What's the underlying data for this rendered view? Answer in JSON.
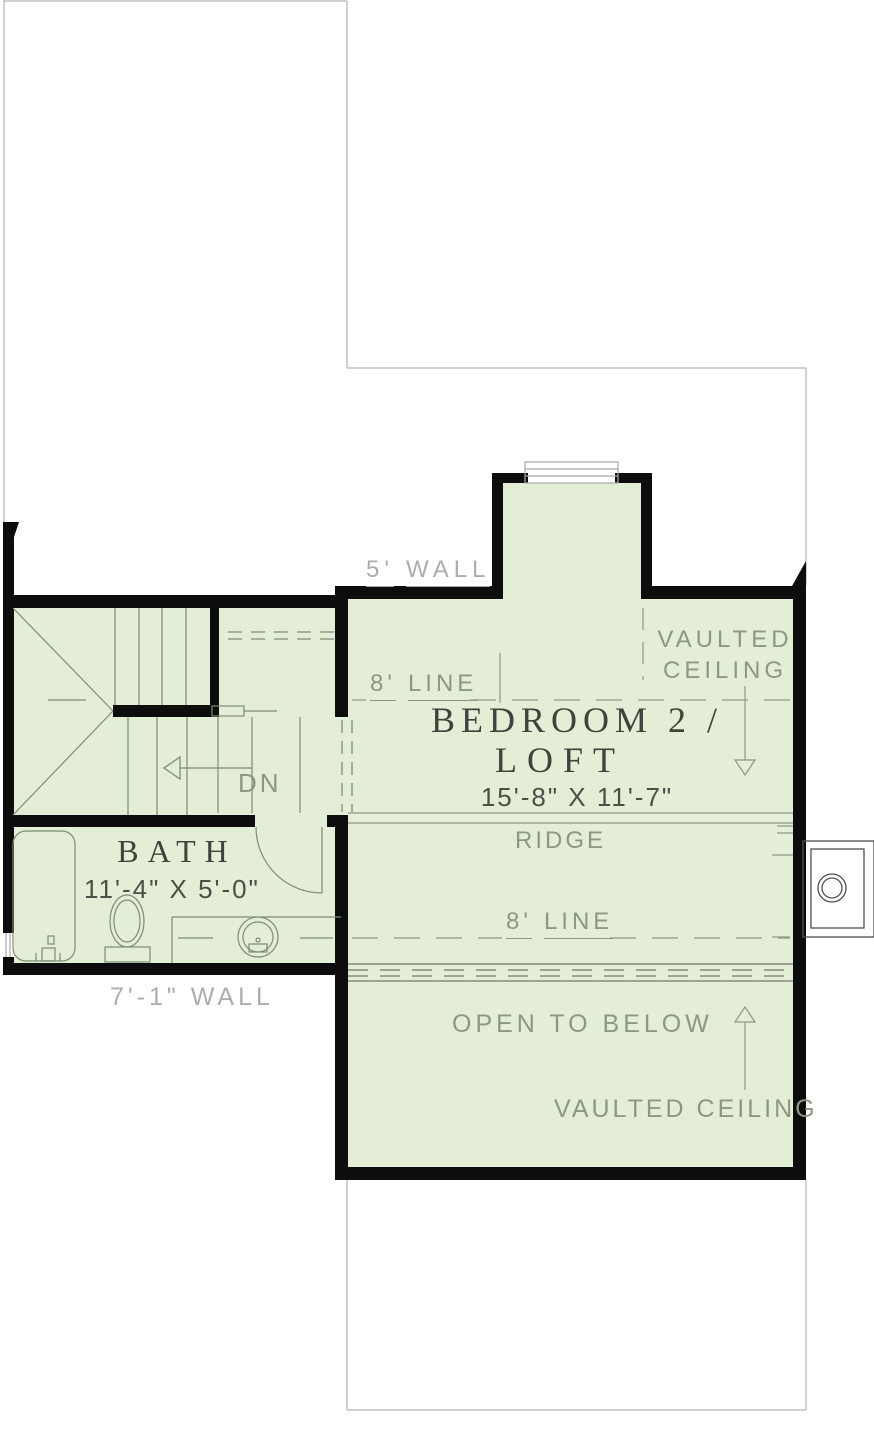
{
  "canvas": {
    "width": 874,
    "height": 1453
  },
  "colors": {
    "floor_fill": "#e4edd6",
    "wall": "#0d0d0d",
    "annotation_green": "#8d9883",
    "annotation_gray": "#adadad",
    "room_label": "#3e443d",
    "dimension_text": "#4a5048",
    "linework": "#7e8c77",
    "reference_line": "#b5b5b5",
    "chimney_line": "#4f4f4f"
  },
  "rooms": {
    "bedroom_loft": {
      "name_line1": "BEDROOM 2 /",
      "name_line2": "LOFT",
      "dimensions": "15'-8\" X 11'-7\""
    },
    "bath": {
      "name": "BATH",
      "dimensions": "11'-4\" X 5'-0\""
    }
  },
  "annotations": {
    "wall_height_top": {
      "value": "5'",
      "unit": "WALL"
    },
    "wall_height_bottom": "7'-1\" WALL",
    "ceiling_line_upper": {
      "value": "8'",
      "unit": "LINE"
    },
    "ceiling_line_lower": {
      "value": "8'",
      "unit": "LINE"
    },
    "vaulted_ceiling_top": {
      "line1": "VAULTED",
      "line2": "CEILING"
    },
    "vaulted_ceiling_bottom": "VAULTED CEILING",
    "ridge": "RIDGE",
    "open_to_below": "OPEN TO BELOW",
    "stair_direction": "DN"
  }
}
